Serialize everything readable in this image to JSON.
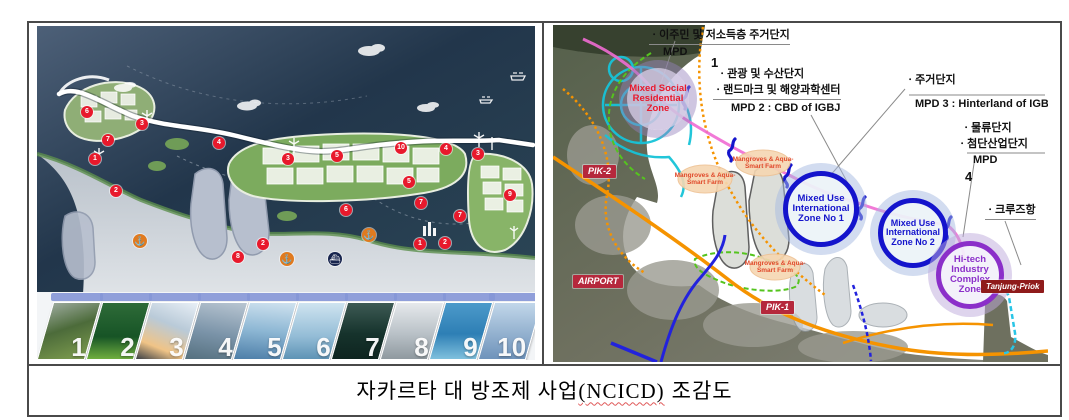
{
  "caption": {
    "prefix": "자카르타 대 방조제 사업",
    "code": "(NCICD)",
    "suffix": "조감도"
  },
  "left_map": {
    "markers": [
      "6",
      "3",
      "7",
      "4",
      "1",
      "3",
      "5",
      "10",
      "4",
      "3",
      "2",
      "2",
      "8",
      "5",
      "7",
      "6",
      "7",
      "1",
      "2",
      "9"
    ],
    "thumbnails": [
      "1",
      "2",
      "3",
      "4",
      "5",
      "6",
      "7",
      "8",
      "9",
      "10"
    ],
    "marker_color": "#e8192c",
    "seawall_color": "#ffffff"
  },
  "right_map": {
    "annotations": {
      "g1_line1": "ㆍ이주민 및 저소득층 주거단지",
      "g1_mpd": "MPD",
      "g1_num": "1",
      "g2_line1": "ㆍ관광 및 수산단지",
      "g2_line2": "ㆍ랜드마크 및 해양과학센터",
      "g2_mpd": "MPD 2 : CBD of IGBJ",
      "g3_line1": "ㆍ주거단지",
      "g3_mpd": "MPD 3 : Hinterland of IGBJ",
      "g4_line1": "ㆍ물류단지",
      "g4_line2": "ㆍ첨단산업단지",
      "g4_mpd": "MPD",
      "g4_num": "4",
      "g5_line1": "ㆍ크루즈항"
    },
    "zones": {
      "social": "Mixed Social Residential Zone",
      "mixed1": "Mixed Use International Zone No 1",
      "mixed2": "Mixed Use International Zone No 2",
      "hitech": "Hi-tech Industry Complex Zone"
    },
    "place_labels": {
      "pik2": "PIK-2",
      "airport": "AIRPORT",
      "pik1": "PIK-1",
      "tanjung": "Tanjung-Priok"
    },
    "mangrove_label": "Mangroves & Aqua-Smart Farm",
    "colors": {
      "zone_blue": "#1414cc",
      "zone_purple": "#8b2fc9",
      "zone_red_text": "#e8192c",
      "seawall_pink": "#ef6cd3",
      "road_orange": "#f59300",
      "road_blue": "#2222dd",
      "road_green": "#55c41e",
      "network_cyan": "#17c3d8",
      "label_red_bg": "#b5283c"
    }
  }
}
